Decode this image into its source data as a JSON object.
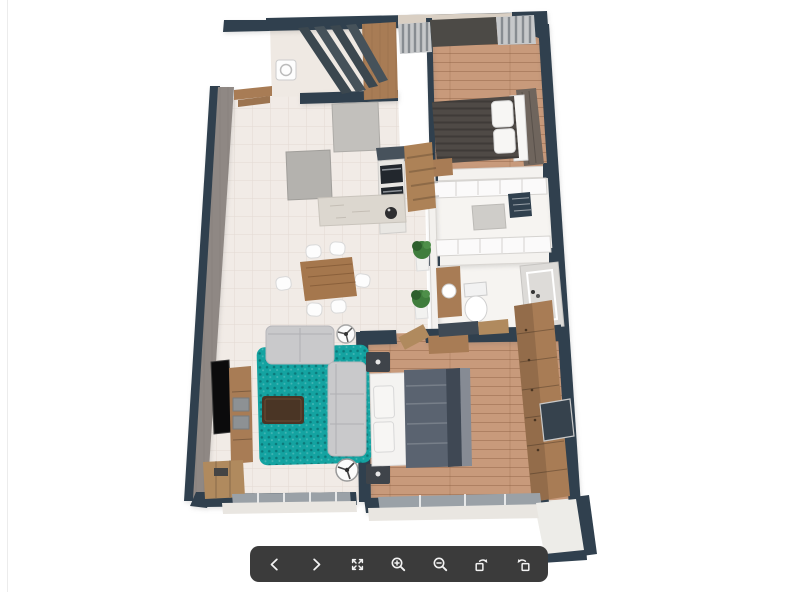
{
  "app": {
    "kind": "3d-floorplan-viewer",
    "background": "#ffffff"
  },
  "colors": {
    "wall": "#30404e",
    "wallLight": "#d9cfc3",
    "leftWallFace": "#8f8884",
    "tile": "#f1ebe6",
    "grout": "#e2dad3",
    "woodFloor": "#c89a7b",
    "woodFurniture": "#a87c55",
    "marble": "#dcd7cf",
    "applianceGray": "#c2c0bc",
    "rug": "#14a3a1",
    "rugDark": "#0c7f7e",
    "sofa": "#c9c9cb",
    "coffeeTable": "#4a3525",
    "diningTable": "#a5774d",
    "chair": "#fdfdfd",
    "duvetMaster": "#5a6370",
    "duvetMasterDark": "#3f4854",
    "duvetGuest": "#4f4a46",
    "pillow": "#f7f6f4",
    "plant": "#3f7d3c",
    "plantDark": "#2e5f2d",
    "pot": "#f2f2f0",
    "glass": "#9aa1a7",
    "sill": "#e9e6e1",
    "balcony": "#edece8",
    "tv": "#0b0b0c",
    "curtain": "#878c91",
    "curtainLight": "#c6c8ca",
    "toolbarBg": "#3b3b3b",
    "icon": "#f2f2f2",
    "edgeLine": "#ececec"
  },
  "toolbar": {
    "buttons": [
      {
        "name": "previous",
        "icon": "chevron-left-icon"
      },
      {
        "name": "next",
        "icon": "chevron-right-icon"
      },
      {
        "name": "fullscreen",
        "icon": "expand-icon"
      },
      {
        "name": "zoom-in",
        "icon": "zoom-in-icon"
      },
      {
        "name": "zoom-out",
        "icon": "zoom-out-icon"
      },
      {
        "name": "rotate-clockwise",
        "icon": "rotate-cw-icon"
      },
      {
        "name": "rotate-counterclockwise",
        "icon": "rotate-ccw-icon"
      }
    ]
  },
  "scene": {
    "type": "apartment-3d-top-view",
    "rooms": [
      "entry-laundry",
      "kitchen",
      "dining-area",
      "living-room",
      "guest-bedroom",
      "walk-in-closet",
      "bathroom",
      "master-bedroom",
      "balcony"
    ]
  }
}
